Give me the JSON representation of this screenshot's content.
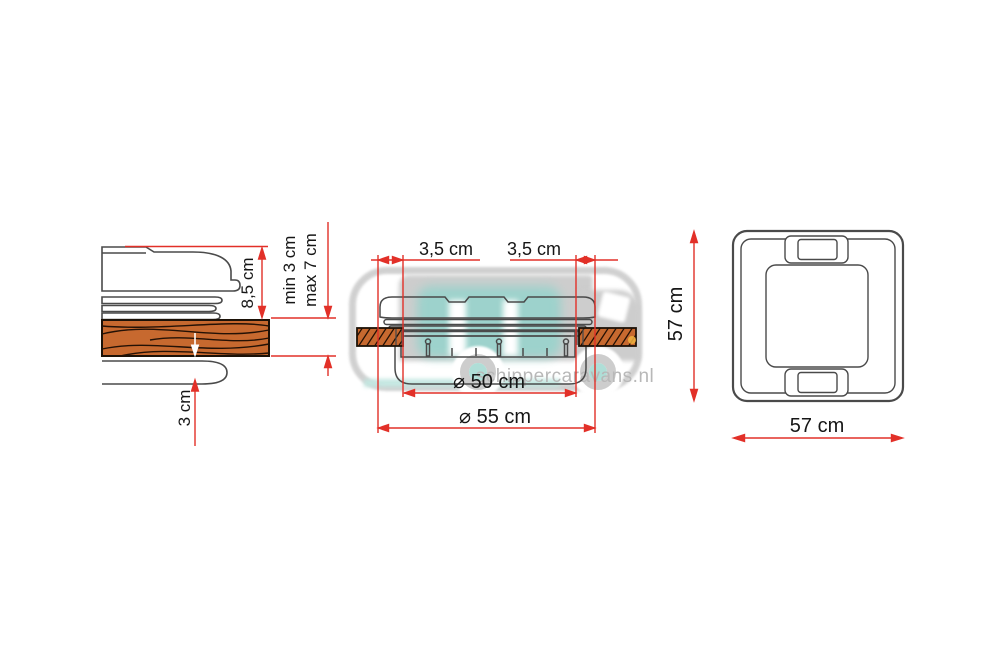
{
  "side_view": {
    "lid_height": "8,5 cm",
    "roof_min": "min 3 cm",
    "roof_max": "max 7 cm",
    "frame_depth": "3 cm"
  },
  "section_view": {
    "flange_left": "3,5 cm",
    "flange_right": "3,5 cm",
    "cutout_diameter": "⌀ 50 cm",
    "outer_diameter": "⌀ 55 cm"
  },
  "top_view": {
    "height": "57 cm",
    "width": "57 cm"
  },
  "watermark": {
    "text": "schippercaravans.nl"
  },
  "colors": {
    "dimension_red": "#e23028",
    "wood": "#c7692f",
    "line_gray": "#4a4a4a",
    "watermark_gray": "#c9c9c9",
    "watermark_teal": "#8cd1c8"
  }
}
